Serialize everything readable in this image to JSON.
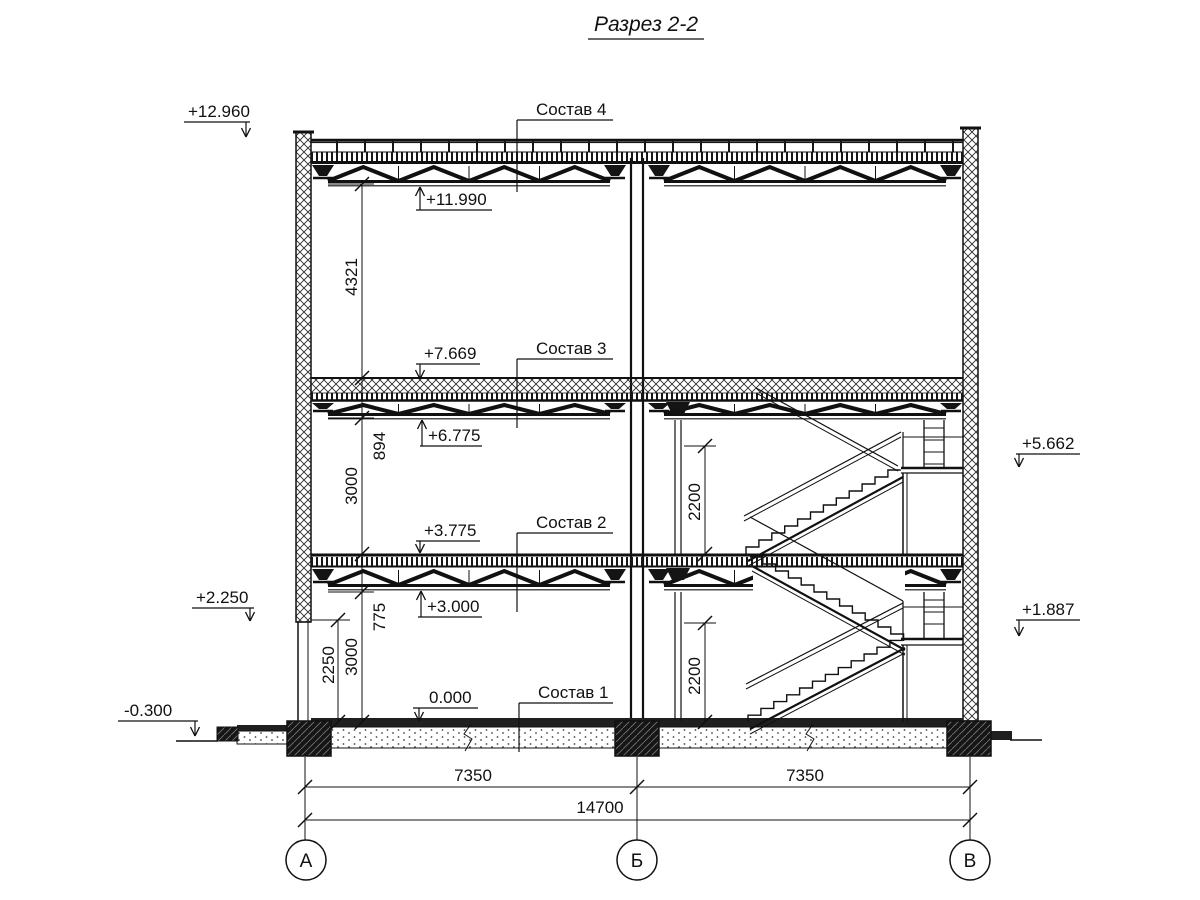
{
  "title": "Разрез 2-2",
  "marks": {
    "m12960": "+12.960",
    "m11990": "+11.990",
    "m7669": "+7.669",
    "m6775": "+6.775",
    "m5662": "+5.662",
    "m3775": "+3.775",
    "m3000": "+3.000",
    "m2250": "+2.250",
    "m1887": "+1.887",
    "m0000": "0.000",
    "m0300": "-0.300"
  },
  "callouts": {
    "sostav4": "Состав 4",
    "sostav3": "Состав 3",
    "sostav2": "Состав 2",
    "sostav1": "Состав 1"
  },
  "dims": {
    "v4321": "4321",
    "v894": "894",
    "v3000_mid": "3000",
    "v775": "775",
    "v3000_low": "3000",
    "v2250": "2250",
    "v2200_up": "2200",
    "v2200_low": "2200",
    "h7350_left": "7350",
    "h7350_right": "7350",
    "h14700": "14700"
  },
  "axes": {
    "left": "А",
    "middle": "Б",
    "right": "В"
  }
}
